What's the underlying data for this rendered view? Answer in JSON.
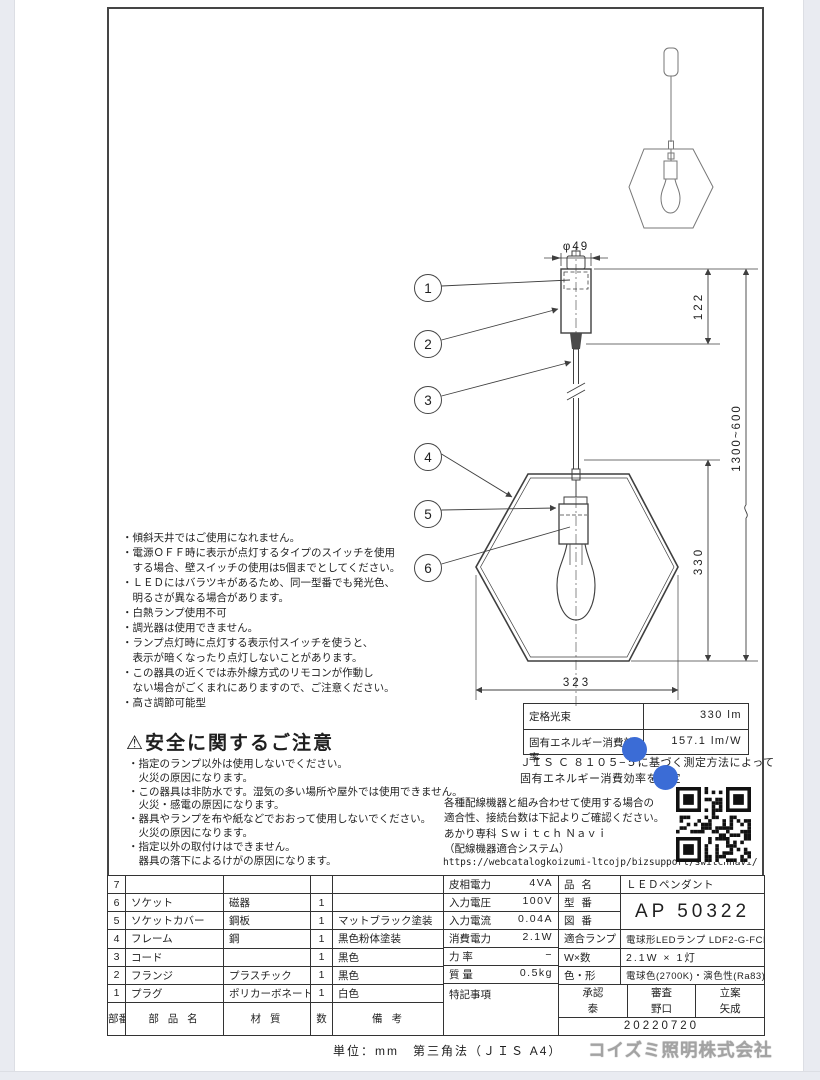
{
  "drawing": {
    "dim_phi": "φ49",
    "dim_canopy_height": "122",
    "dim_cord_height": "1300~600",
    "dim_fixture_height": "330",
    "dim_fixture_width": "323",
    "callouts": {
      "c1": "1",
      "c2": "2",
      "c3": "3",
      "c4": "4",
      "c5": "5",
      "c6": "6"
    }
  },
  "notes": [
    "・傾斜天井ではご使用になれません。",
    "・電源ＯＦＦ時に表示が点灯するタイプのスイッチを使用",
    "　する場合、壁スイッチの使用は5個までとしてください。",
    "・ＬＥＤにはバラツキがあるため、同一型番でも発光色、",
    "　明るさが異なる場合があります。",
    "・白熱ランプ使用不可",
    "・調光器は使用できません。",
    "・ランプ点灯時に点灯する表示付スイッチを使うと、",
    "　表示が暗くなったり点灯しないことがあります。",
    "・この器具の近くでは赤外線方式のリモコンが作動し",
    "　ない場合がごくまれにありますので、ご注意ください。",
    "・高さ調節可能型"
  ],
  "safety": {
    "warning_icon": "⚠",
    "title": "安全に関するご注意",
    "items": [
      "・指定のランプ以外は使用しないでください。",
      "　火災の原因になります。",
      "・この器具は非防水です。湿気の多い場所や屋外では使用できません。",
      "　火災・感電の原因になります。",
      "・器具やランプを布や紙などでおおって使用しないでください。",
      "　火災の原因になります。",
      "・指定以外の取付けはできません。",
      "　器具の落下によるけがの原因になります。"
    ]
  },
  "photometrics": {
    "luminous_flux_label": "定格光束",
    "luminous_flux_value": "330 lm",
    "efficacy_label": "固有エネルギー消費効率",
    "efficacy_value": "157.1 lm/W",
    "note_line1": "ＪＩＳ Ｃ ８１０５−５に基づく測定方法によって",
    "note_line2": "固有エネルギー消費効率を測定"
  },
  "wiring": {
    "line1": "各種配線機器と組み合わせて使用する場合の",
    "line2": "適合性、接続台数は下記よりご確認ください。",
    "line3": "あかり専科 Ｓｗｉｔｃｈ Ｎａｖｉ",
    "line4": "（配線機器適合システム）",
    "url": "https://webcatalogkoizumi-ltcojp/bizsupport/switchnavi/",
    "qr_code": "qr-code"
  },
  "parts_table": {
    "header": {
      "no": "部番",
      "name": "部 品 名",
      "material": "材 質",
      "qty": "数",
      "note": "備 考"
    },
    "rows": [
      {
        "no": "7",
        "name": "",
        "material": "",
        "qty": "",
        "note": ""
      },
      {
        "no": "6",
        "name": "ソケット",
        "material": "磁器",
        "qty": "1",
        "note": ""
      },
      {
        "no": "5",
        "name": "ソケットカバー",
        "material": "鋼板",
        "qty": "1",
        "note": "マットブラック塗装"
      },
      {
        "no": "4",
        "name": "フレーム",
        "material": "鋼",
        "qty": "1",
        "note": "黒色粉体塗装"
      },
      {
        "no": "3",
        "name": "コード",
        "material": "",
        "qty": "1",
        "note": "黒色"
      },
      {
        "no": "2",
        "name": "フランジ",
        "material": "プラスチック",
        "qty": "1",
        "note": "黒色"
      },
      {
        "no": "1",
        "name": "プラグ",
        "material": "ポリカーボネート",
        "qty": "1",
        "note": "白色"
      }
    ]
  },
  "electrical": {
    "rows": [
      {
        "label": "皮相電力",
        "value": "4VA"
      },
      {
        "label": "入力電圧",
        "value": "100V"
      },
      {
        "label": "入力電流",
        "value": "0.04A"
      },
      {
        "label": "消費電力",
        "value": "2.1W"
      },
      {
        "label": "力 率",
        "value": "−"
      },
      {
        "label": "質 量",
        "value": "0.5kg"
      }
    ],
    "remarks_label": "特記事項"
  },
  "product": {
    "name_label": "品 名",
    "name": "ＬＥＤペンダント",
    "model_label": "型 番",
    "drawing_no_label": "図 番",
    "model_no": "AP 50322",
    "lamp_label": "適合ランプ",
    "lamp": "電球形LEDランプ LDF2-G-FCK",
    "wattage_label": "W×数",
    "wattage": "2.1W × 1灯",
    "color_label": "色・形",
    "color": "電球色(2700K)・演色性(Ra83)",
    "approval": [
      {
        "role": "承認",
        "name": "泰"
      },
      {
        "role": "審査",
        "name": "野口"
      },
      {
        "role": "立案",
        "name": "矢成"
      }
    ],
    "date": "20220720"
  },
  "footer": {
    "units": "単位：mm",
    "projection": "第三角法（ＪＩＳ A4）",
    "company": "コイズミ照明株式会社"
  },
  "colors": {
    "annotation_dot": "#3b6cd6",
    "line": "#3f3f3f",
    "logo_gray": "#a3a3a3"
  }
}
